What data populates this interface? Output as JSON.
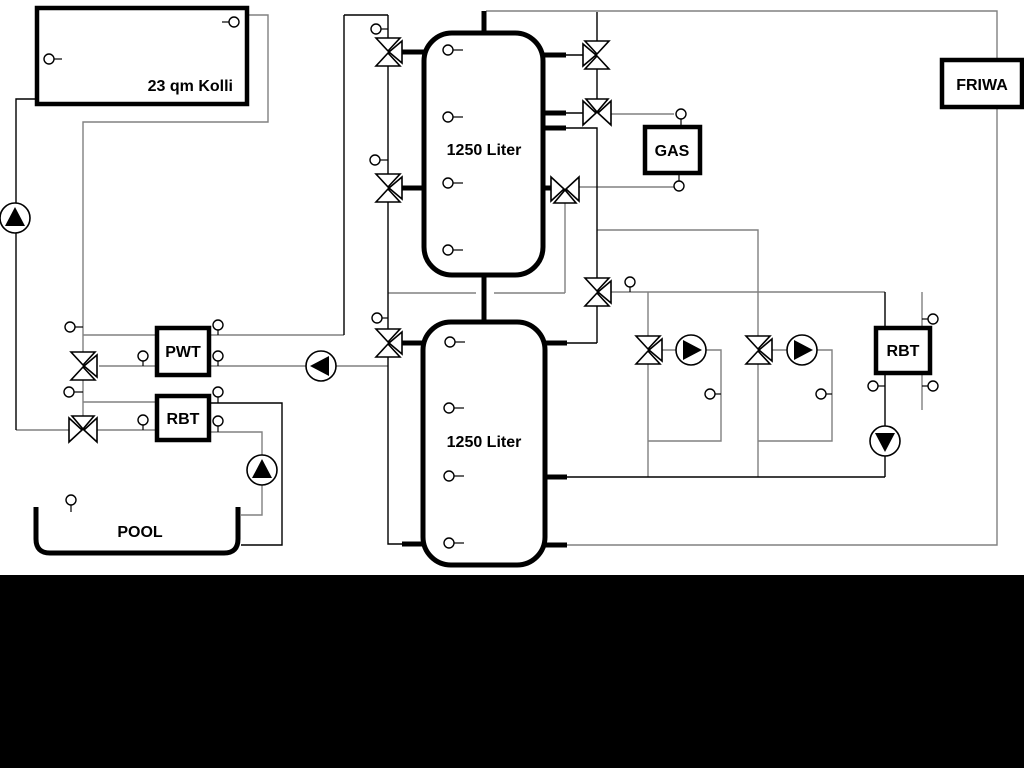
{
  "diagram": {
    "labels": {
      "collector": "23 qm Kolli",
      "buffer_tank_upper": "1250 Liter",
      "buffer_tank_lower": "1250 Liter",
      "pool_heat_exchanger": "PWT",
      "pool_return_unit": "RBT",
      "pool": "POOL",
      "gas_boiler": "GAS",
      "fresh_water_station": "FRIWA",
      "heating_return_unit": "RBT"
    },
    "colors": {
      "line_gray": "#808080",
      "line_black": "#000000",
      "background": "#ffffff",
      "footer_band": "#000000"
    }
  }
}
